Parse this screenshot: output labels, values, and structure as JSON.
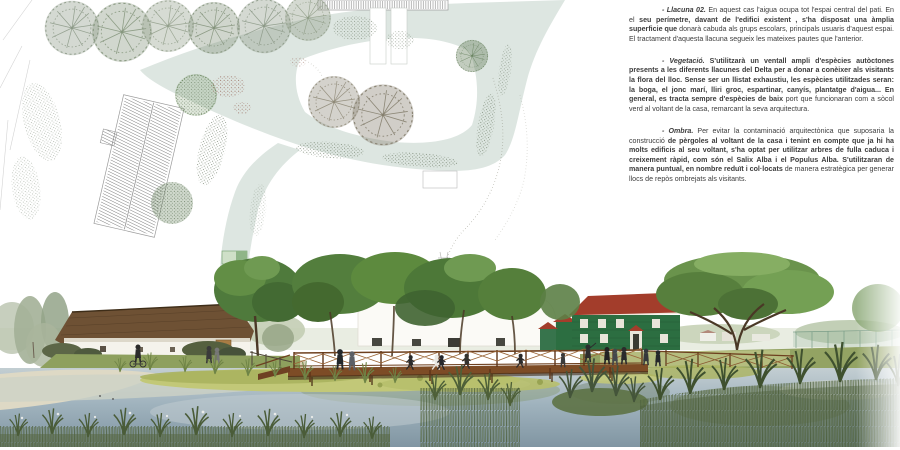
{
  "text_column": {
    "paragraphs": [
      {
        "lead": "- Llacuna 02.",
        "segments": [
          {
            "text": " En aquest cas l'aigua ocupa tot l'espai central del pati. En el ",
            "bold": false
          },
          {
            "text": "seu perímetre, davant de l'edifici existent , s'ha disposat una àmplia superficie que",
            "bold": true
          },
          {
            "text": " donarà cabuda als grups escolars, principals usuaris d'aquest espai. El tractament d'aquesta llacuna segueix les mateixes pautes que l'anterior.",
            "bold": false
          }
        ]
      },
      {
        "lead": "- Vegetació.",
        "segments": [
          {
            "text": " S'utilitzarà un ventall ampli d'espècies autòctones presents a les diferents llacunes del Delta per a donar a conèixer als visitants la flora del lloc. Sense ser un llistat exhaustiu, les espècies utilitzades seran: la boga, el jonc marí, lliri groc, espartinar, canyís, plantatge d'aigua... En general, es tracta sempre d'espècies de baix",
            "bold": true
          },
          {
            "text": " port que funcionaran com a sòcol verd al voltant de la casa, remarcant la seva arquitectura.",
            "bold": false
          }
        ]
      },
      {
        "lead": "- Ombra.",
        "segments": [
          {
            "text": " Per evitar la contaminació arquitectònica que suposaria la construcció",
            "bold": false
          },
          {
            "text": " de pèrgoles al voltant de la casa i tenint en compte que ja hi ha molts edificis al seu voltant, s'ha optat per utilitzar arbres de fulla caduca i creixement ràpid, com són el Salix Alba i el Populus Alba. S'utilitzaran de manera puntual, en nombre reduït  i col·locats",
            "bold": true
          },
          {
            "text": " de manera estratègica per generar llocs de repòs ombrejats als visitants.",
            "bold": false
          }
        ]
      }
    ]
  },
  "palette": {
    "lagoon": "#dde6e1",
    "plan_tree": "#8d9a88",
    "water": "#a4b6c0",
    "water_deep": "#7e93a0",
    "algae": "#c2c878",
    "canopy": "#55813c",
    "thatch": "#6e5134",
    "farmhouse_wall": "#f5f3ec",
    "green_house": "#2c6e41",
    "green_house_roof": "#a33d2b",
    "boardwalk": "#7d4c26",
    "reed": "#46572f",
    "beach_sand": "#ded9c5",
    "text": "#3c3c3c"
  }
}
